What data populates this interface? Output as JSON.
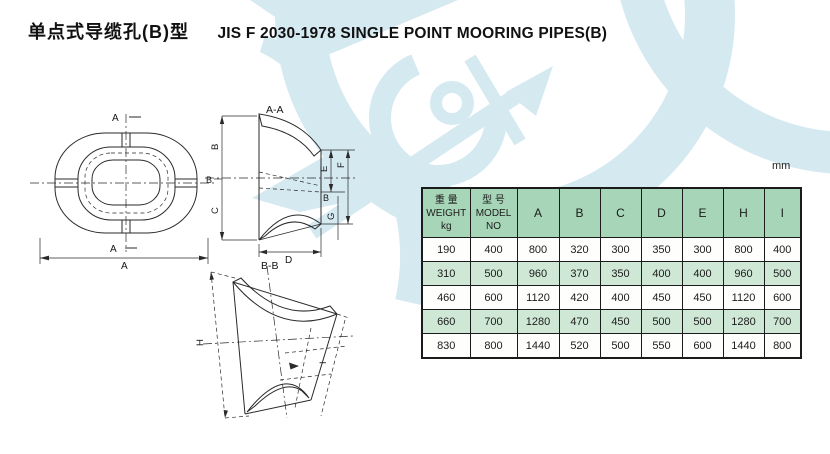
{
  "page": {
    "title_zh": "单点式导缆孔(B)型",
    "title_en": "JIS F 2030-1978 SINGLE POINT MOORING PIPES(B)",
    "unit_label": "mm"
  },
  "drawings": {
    "plan": {
      "section_marker_top": "A",
      "section_marker_bottom": "A",
      "dim_width": "A"
    },
    "section_aa": {
      "title": "A-A",
      "dim_b": "B",
      "dim_c": "C",
      "dim_d": "D",
      "dim_e": "E",
      "dim_f": "F",
      "dim_g": "G",
      "cut_marker_left": "B",
      "cut_marker_right": "B"
    },
    "section_bb": {
      "title": "B-B",
      "dim_h": "H",
      "dim_i": "I"
    }
  },
  "table": {
    "weight_header": {
      "zh": "重 量",
      "en": "WEIGHT",
      "unit": "kg"
    },
    "model_header": {
      "zh": "型 号",
      "en": "MODEL NO"
    },
    "letter_columns": [
      "A",
      "B",
      "C",
      "D",
      "E",
      "H",
      "I"
    ],
    "rows": [
      [
        "190",
        "400",
        "800",
        "320",
        "300",
        "350",
        "300",
        "800",
        "400"
      ],
      [
        "310",
        "500",
        "960",
        "370",
        "350",
        "400",
        "400",
        "960",
        "500"
      ],
      [
        "460",
        "600",
        "1120",
        "420",
        "400",
        "450",
        "450",
        "1120",
        "600"
      ],
      [
        "660",
        "700",
        "1280",
        "470",
        "450",
        "500",
        "500",
        "1280",
        "700"
      ],
      [
        "830",
        "800",
        "1440",
        "520",
        "500",
        "550",
        "600",
        "1440",
        "800"
      ]
    ]
  },
  "colors": {
    "table_header_green": "#a7d5b7",
    "table_row_alt_green": "#cfe8d5",
    "watermark_blue": "#d5e9f1",
    "line_dark": "#1f1f1f"
  }
}
